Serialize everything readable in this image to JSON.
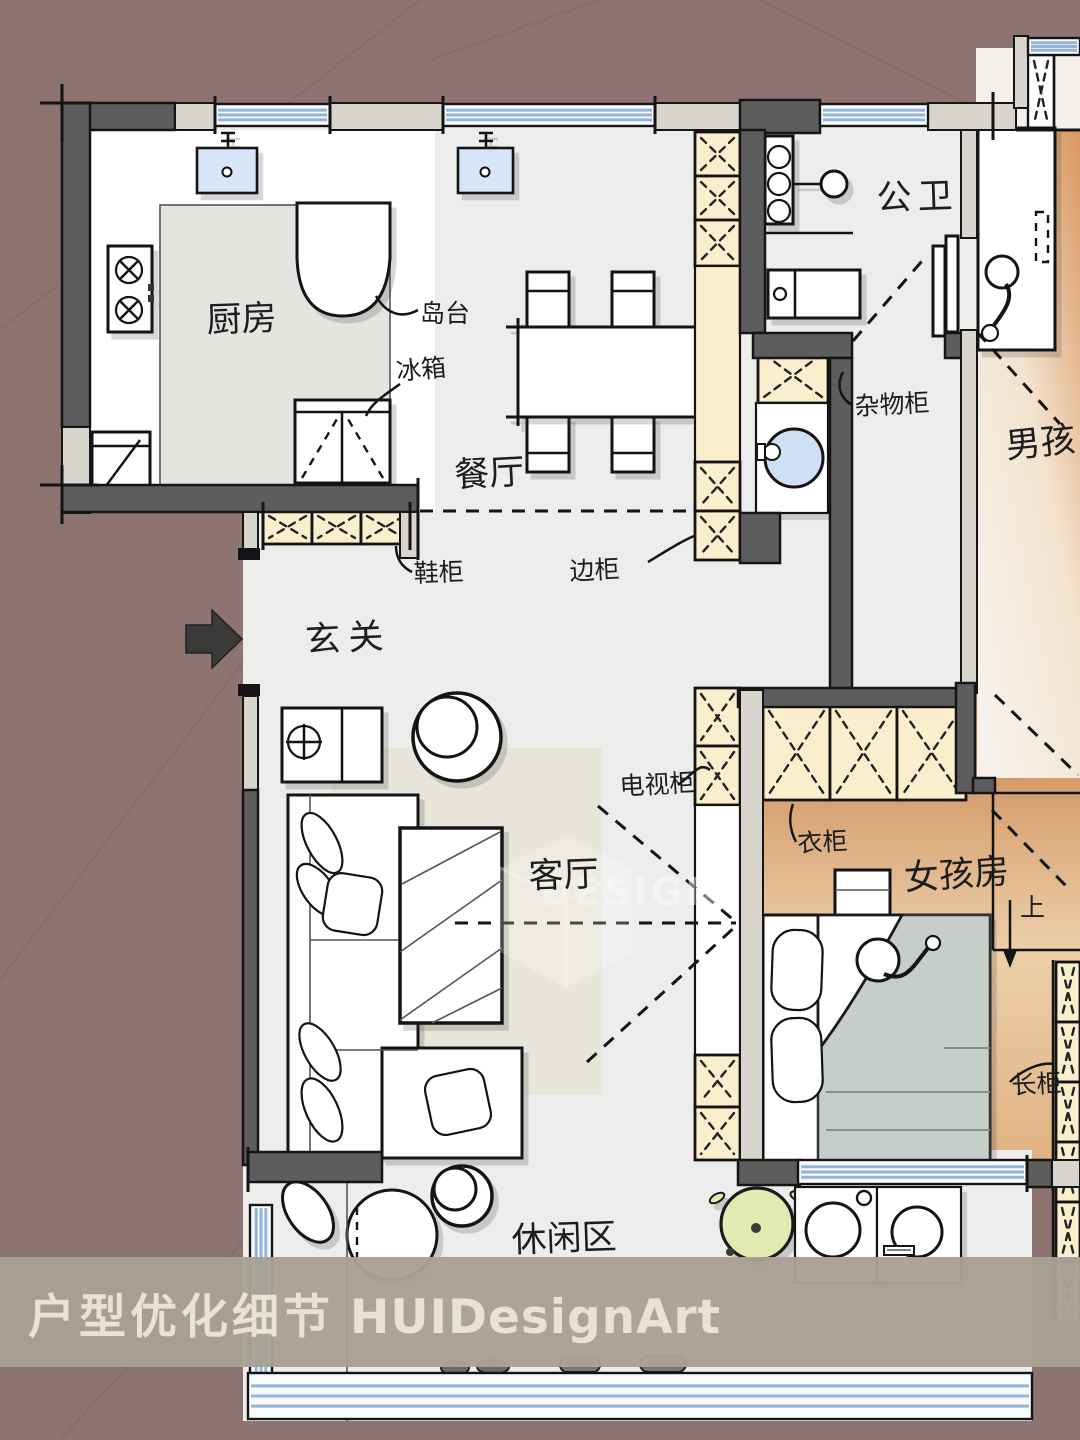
{
  "banner": {
    "title_zh": "户型优化细节",
    "brand": "HUIDesignArt"
  },
  "watermark": {
    "text": "DESIGN"
  },
  "rooms": {
    "kitchen": "厨房",
    "dining": "餐厅",
    "public_bath": "公卫",
    "boy_room": "男孩",
    "entry": "玄关",
    "living": "客厅",
    "girl_room": "女孩房",
    "leisure": "休闲区"
  },
  "annotations": {
    "island": "岛台",
    "fridge": "冰箱",
    "sundry_cabinet": "杂物柜",
    "shoe_cabinet": "鞋柜",
    "side_cabinet": "边柜",
    "tv_cabinet": "电视柜",
    "wardrobe": "衣柜",
    "stairs_up": "上",
    "long_cabinet": "长柜"
  },
  "colors": {
    "background": "#8d7470",
    "wall_dark": "#5e5d5d",
    "wall_light": "#d8d5cd",
    "floor": "#ededeb",
    "kitchen_walk": "#e4e4e1",
    "cabinet_cream": "#faeecd",
    "window_line": "#93b4d8",
    "girl_orange_dark": "#c8824a",
    "boy_orange": "#d9965e",
    "rug": "#e8e6da",
    "blanket": "#c7cdc9",
    "sink_blue": "#d9e6f8",
    "plant_green": "#e2eab2",
    "banner_bg": "#a7a196",
    "banner_text": "#e9e3d4"
  }
}
